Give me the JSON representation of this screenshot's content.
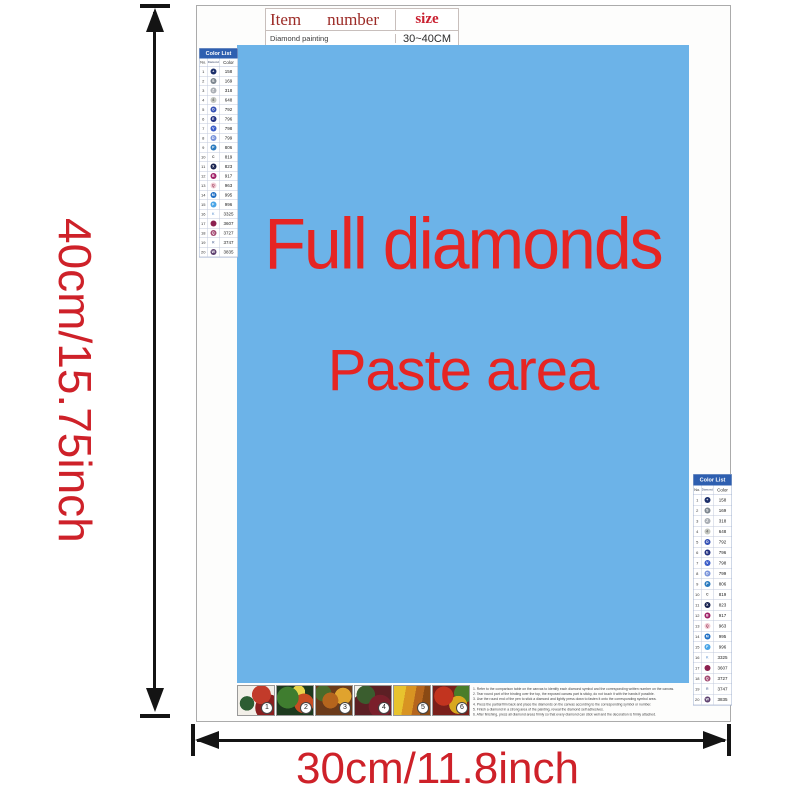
{
  "colors": {
    "paste_bg": "#6cb3e8",
    "paste_text": "#e62523",
    "dimension_text": "#ce2129",
    "list_header_bg": "#2e5fb0"
  },
  "dim": {
    "height_label": "40cm/15.75inch",
    "width_label": "30cm/11.8inch"
  },
  "item_table": {
    "item": "Item",
    "number": "number",
    "size": "size",
    "row_item": "Diamond painting",
    "row_size": "30~40CM"
  },
  "paste": {
    "line1": "Full diamonds",
    "line2": "Paste area"
  },
  "color_list": {
    "title": "Color List",
    "col_no": "No.",
    "col_diamond": "Diamond",
    "col_color": "Color",
    "rows": [
      {
        "no": "1",
        "glyph": "+",
        "bg": "#1c2f6b",
        "fg": "#ffffff",
        "code": "158"
      },
      {
        "no": "2",
        "glyph": "S",
        "bg": "#7d868f",
        "fg": "#ffffff",
        "code": "169"
      },
      {
        "no": "3",
        "glyph": "Z",
        "bg": "#a9aeb4",
        "fg": "#ffffff",
        "code": "318"
      },
      {
        "no": "4",
        "glyph": "4",
        "bg": "#c3c6c0",
        "fg": "#666666",
        "code": "648"
      },
      {
        "no": "5",
        "glyph": "O",
        "bg": "#3450b4",
        "fg": "#ffffff",
        "code": "792"
      },
      {
        "no": "6",
        "glyph": "E",
        "bg": "#202f80",
        "fg": "#ffffff",
        "code": "796"
      },
      {
        "no": "7",
        "glyph": "V",
        "bg": "#3a5cc8",
        "fg": "#ffffff",
        "code": "798"
      },
      {
        "no": "8",
        "glyph": "D",
        "bg": "#7a94da",
        "fg": "#ffffff",
        "code": "799"
      },
      {
        "no": "9",
        "glyph": "P",
        "bg": "#2a7abe",
        "fg": "#ffffff",
        "code": "806"
      },
      {
        "no": "10",
        "glyph": "C",
        "bg": "transparent",
        "fg": "#444444",
        "code": "819"
      },
      {
        "no": "11",
        "glyph": "X",
        "bg": "#16204e",
        "fg": "#ffffff",
        "code": "823"
      },
      {
        "no": "12",
        "glyph": "B",
        "bg": "#a02168",
        "fg": "#ffffff",
        "code": "917"
      },
      {
        "no": "13",
        "glyph": "Q",
        "bg": "#f2ccd6",
        "fg": "#90304e",
        "code": "963"
      },
      {
        "no": "14",
        "glyph": "M",
        "bg": "#1e6ec4",
        "fg": "#ffffff",
        "code": "995"
      },
      {
        "no": "15",
        "glyph": "F",
        "bg": "#48a4e6",
        "fg": "#ffffff",
        "code": "996"
      },
      {
        "no": "16",
        "glyph": "K",
        "bg": "transparent",
        "fg": "#7fa9d9",
        "code": "3325"
      },
      {
        "no": "17",
        "glyph": "",
        "bg": "#8c2150",
        "fg": "#8c2150",
        "code": "3607"
      },
      {
        "no": "18",
        "glyph": "Q",
        "bg": "#a34a72",
        "fg": "#ffffff",
        "code": "3727"
      },
      {
        "no": "19",
        "glyph": "R",
        "bg": "transparent",
        "fg": "#7c8cb0",
        "code": "3747"
      },
      {
        "no": "20",
        "glyph": "W",
        "bg": "#5e4170",
        "fg": "#ffffff",
        "code": "3835"
      }
    ]
  },
  "thumbnails": [
    {
      "num": "1",
      "art": "t1"
    },
    {
      "num": "2",
      "art": "t2"
    },
    {
      "num": "3",
      "art": "t3"
    },
    {
      "num": "4",
      "art": "t4"
    },
    {
      "num": "5",
      "art": "t5"
    },
    {
      "num": "6",
      "art": "t6"
    }
  ],
  "instructions": {
    "lines": [
      "1. Refer to the comparison table on the canvas to identify each diamond symbol and the corresponding written number on the canvas.",
      "2. Tear round part of the binding over the top, the exposed canvas part is sticky, do not touch it with the hands if possible.",
      "3. Use the round end of the pen to stick a diamond and lightly press down to fasten it onto the corresponding symbol area.",
      "4. Press the partial film back and place the diamonds on the canvas according to the corresponding symbol or number.",
      "5. Finish a diamond in a strong area of the painting, reveal the diamond self adhesives.",
      "6. After finishing, press all diamond areas firmly so that every diamond can stick well and the decoration is firmly attached."
    ]
  }
}
